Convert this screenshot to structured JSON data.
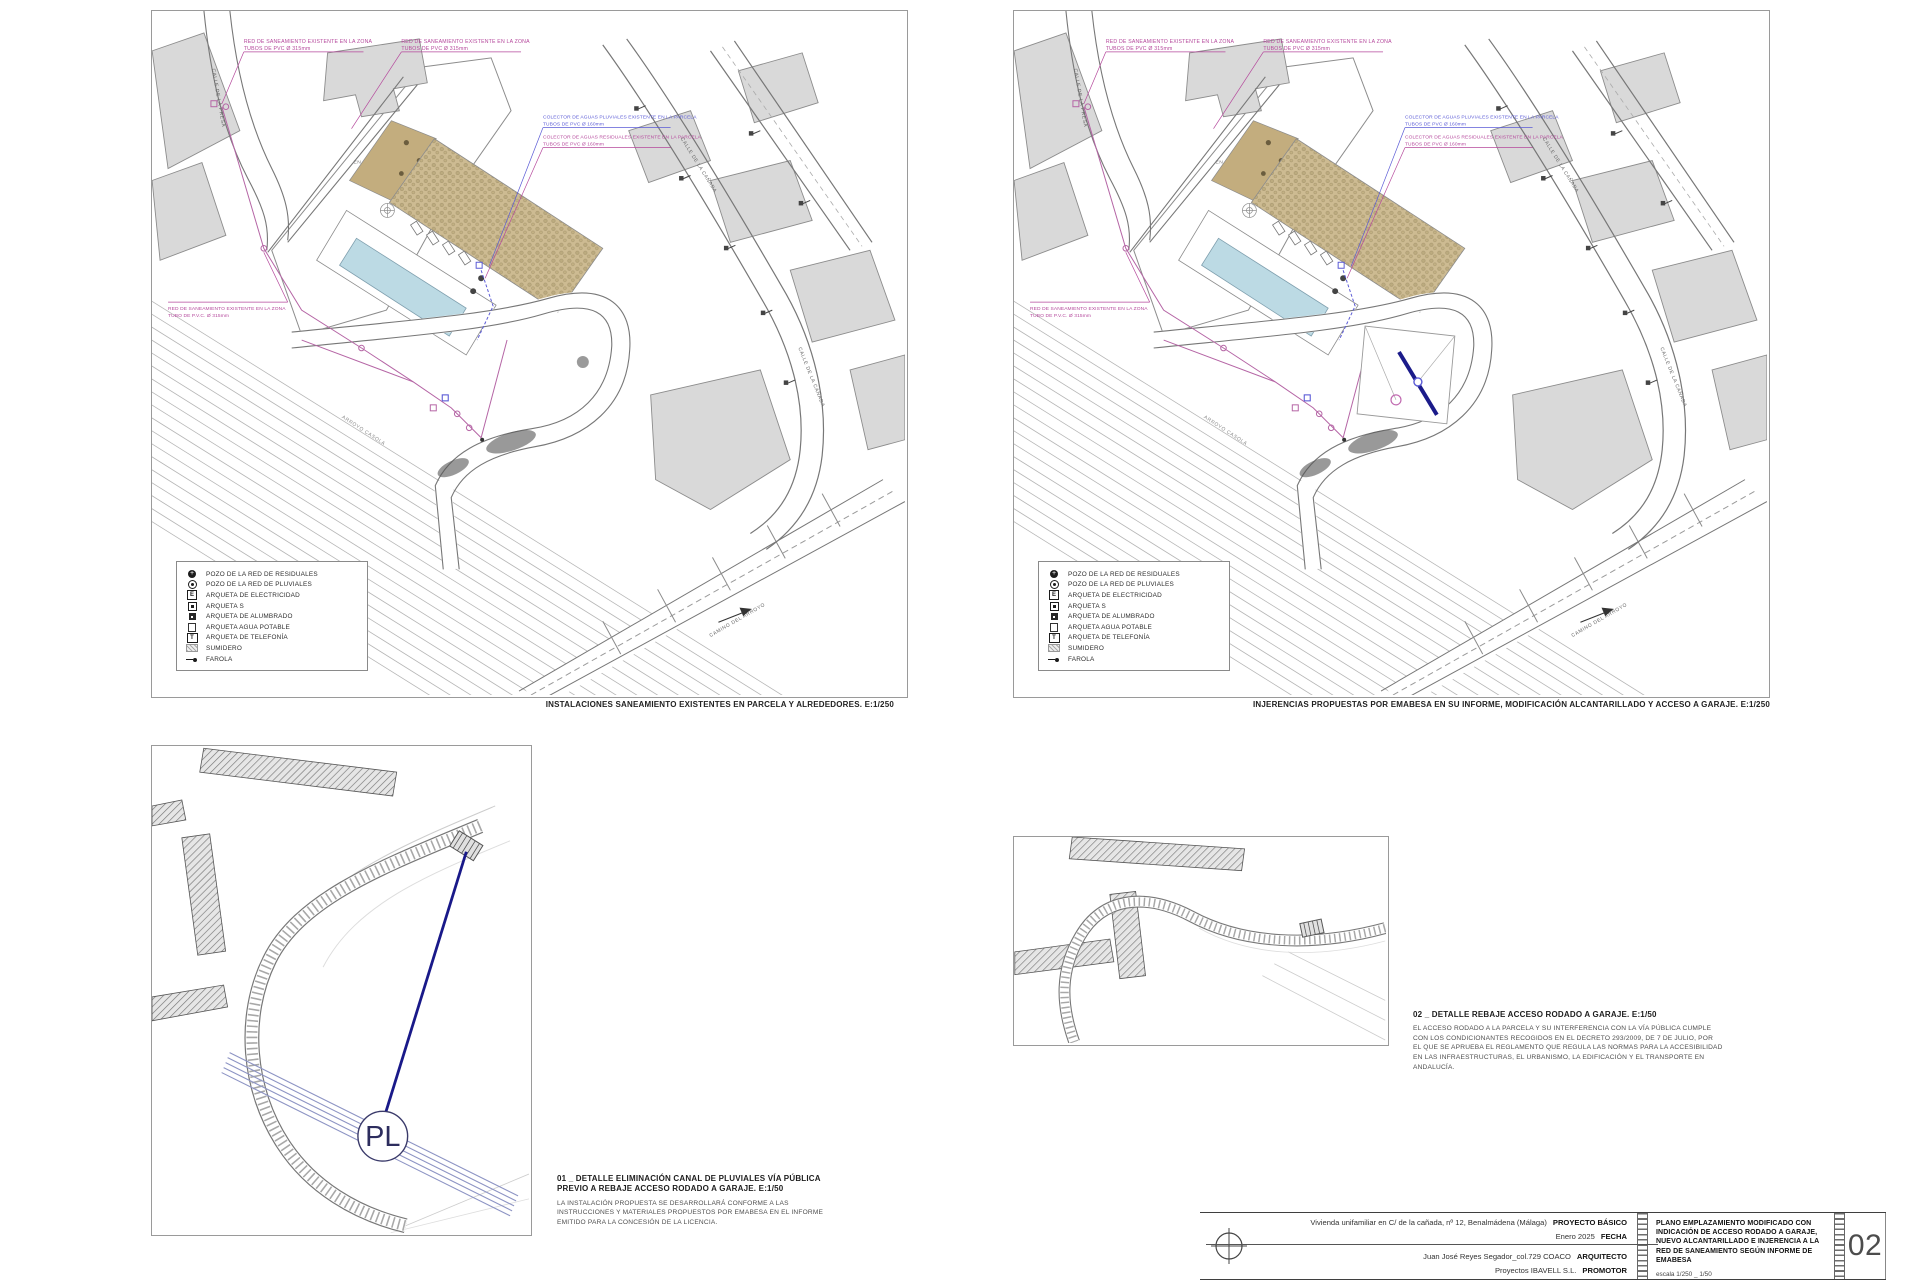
{
  "colors": {
    "annotation_magenta": "#b5489c",
    "annotation_blue": "#5b5bd6",
    "new_line_navy": "#1b1b8a",
    "pool_blue": "#bcdae4",
    "garden_tan": "#cdbb92",
    "building_gray": "#d9d9d9"
  },
  "plans": {
    "left": {
      "caption": "INSTALACIONES SANEAMIENTO EXISTENTES EN PARCELA Y ALREDEDORES. E:1/250"
    },
    "right": {
      "caption": "INJERENCIAS PROPUESTAS POR EMABESA EN SU INFORME, MODIFICACIÓN ALCANTARILLADO Y ACCESO A GARAJE. E:1/250"
    },
    "annotations": {
      "red_saneamiento_l1": "RED DE SANEAMIENTO EXISTENTE EN LA ZONA",
      "red_saneamiento_l2": "TUBOS DE PVC Ø 315mm",
      "colector_pluviales_l1": "COLECTOR DE AGUAS PLUVIALES EXISTENTE EN LA PARCELA",
      "colector_pluviales_l2": "TUBOS DE PVC Ø 160mm",
      "colector_residuales_l1": "COLECTOR DE AGUAS RESIDUALES EXISTENTE EN LA PARCELA",
      "colector_residuales_l2": "TUBOS DE PVC Ø 160mm",
      "red_zona_izq_l1": "RED DE SANEAMIENTO EXISTENTE EN LA ZONA",
      "red_zona_izq_l2": "TUBO DE P.V.C. Ø 315mm",
      "solar_l1": "SOLAR",
      "solar_l2": "EN URBANIZACIÓN",
      "calle_canada": "CALLE DE LA CAÑADA",
      "calle_presa": "CALLE DE LA PRESA",
      "camino_arroyo": "CAMINO DEL ARROYO",
      "arroyo": "ARROYO CASOLA"
    },
    "legend": {
      "items": [
        {
          "icon": "pozo-residuales",
          "label": "POZO DE LA RED DE RESIDUALES"
        },
        {
          "icon": "pozo-pluviales",
          "label": "POZO DE LA RED DE PLUVIALES"
        },
        {
          "icon": "arqueta-electricidad",
          "label": "ARQUETA DE ELECTRICIDAD"
        },
        {
          "icon": "arqueta-s",
          "label": "ARQUETA S"
        },
        {
          "icon": "arqueta-alumbrado",
          "label": "ARQUETA DE ALUMBRADO"
        },
        {
          "icon": "arqueta-agua-potable",
          "label": "ARQUETA AGUA POTABLE"
        },
        {
          "icon": "arqueta-telefonia",
          "label": "ARQUETA DE TELEFONÍA"
        },
        {
          "icon": "sumidero",
          "label": "SUMIDERO"
        },
        {
          "icon": "farola",
          "label": "FAROLA"
        }
      ]
    }
  },
  "details": {
    "d1": {
      "title_l1": "01 _ DETALLE ELIMINACIÓN CANAL DE PLUVIALES VÍA PÚBLICA",
      "title_l2": "PREVIO A REBAJE ACCESO RODADO A GARAJE. E:1/50",
      "body": "LA INSTALACIÓN PROPUESTA SE DESARROLLARÁ CONFORME A LAS INSTRUCCIONES Y MATERIALES PROPUESTOS POR EMABESA EN EL INFORME EMITIDO PARA LA CONCESIÓN DE LA LICENCIA.",
      "pl": "PL"
    },
    "d2": {
      "title": "02 _ DETALLE REBAJE ACCESO RODADO A GARAJE. E:1/50",
      "body": "EL ACCESO RODADO A LA PARCELA Y SU INTERFERENCIA CON LA VÍA PÚBLICA CUMPLE CON LOS CONDICIONANTES RECOGIDOS EN EL DECRETO 293/2009, DE 7 DE JULIO, POR EL QUE SE APRUEBA EL REGLAMENTO QUE REGULA LAS NORMAS PARA LA ACCESIBILIDAD EN LAS INFRAESTRUCTURAS, EL URBANISMO, LA EDIFICACIÓN Y EL TRANSPORTE EN ANDALUCÍA."
    }
  },
  "titleblock": {
    "project": "Vivienda unifamiliar en C/ de la cañada, nº 12, Benalmádena (Málaga)",
    "project_label": "PROYECTO BÁSICO",
    "date": "Enero 2025",
    "date_label": "FECHA",
    "architect": "Juan José Reyes Segador_col.729 COACO",
    "architect_label": "ARQUITECTO",
    "promoter": "Proyectos IBAVELL S.L.",
    "promoter_label": "PROMOTOR",
    "plan_title": "PLANO EMPLAZAMIENTO MODIFICADO CON INDICACIÓN DE ACCESO RODADO A GARAJE, NUEVO ALCANTARILLADO E INJERENCIA A LA RED DE SANEAMIENTO SEGÚN INFORME DE EMABESA",
    "scale": "escala 1/250 _ 1/50",
    "sheet": "02"
  }
}
